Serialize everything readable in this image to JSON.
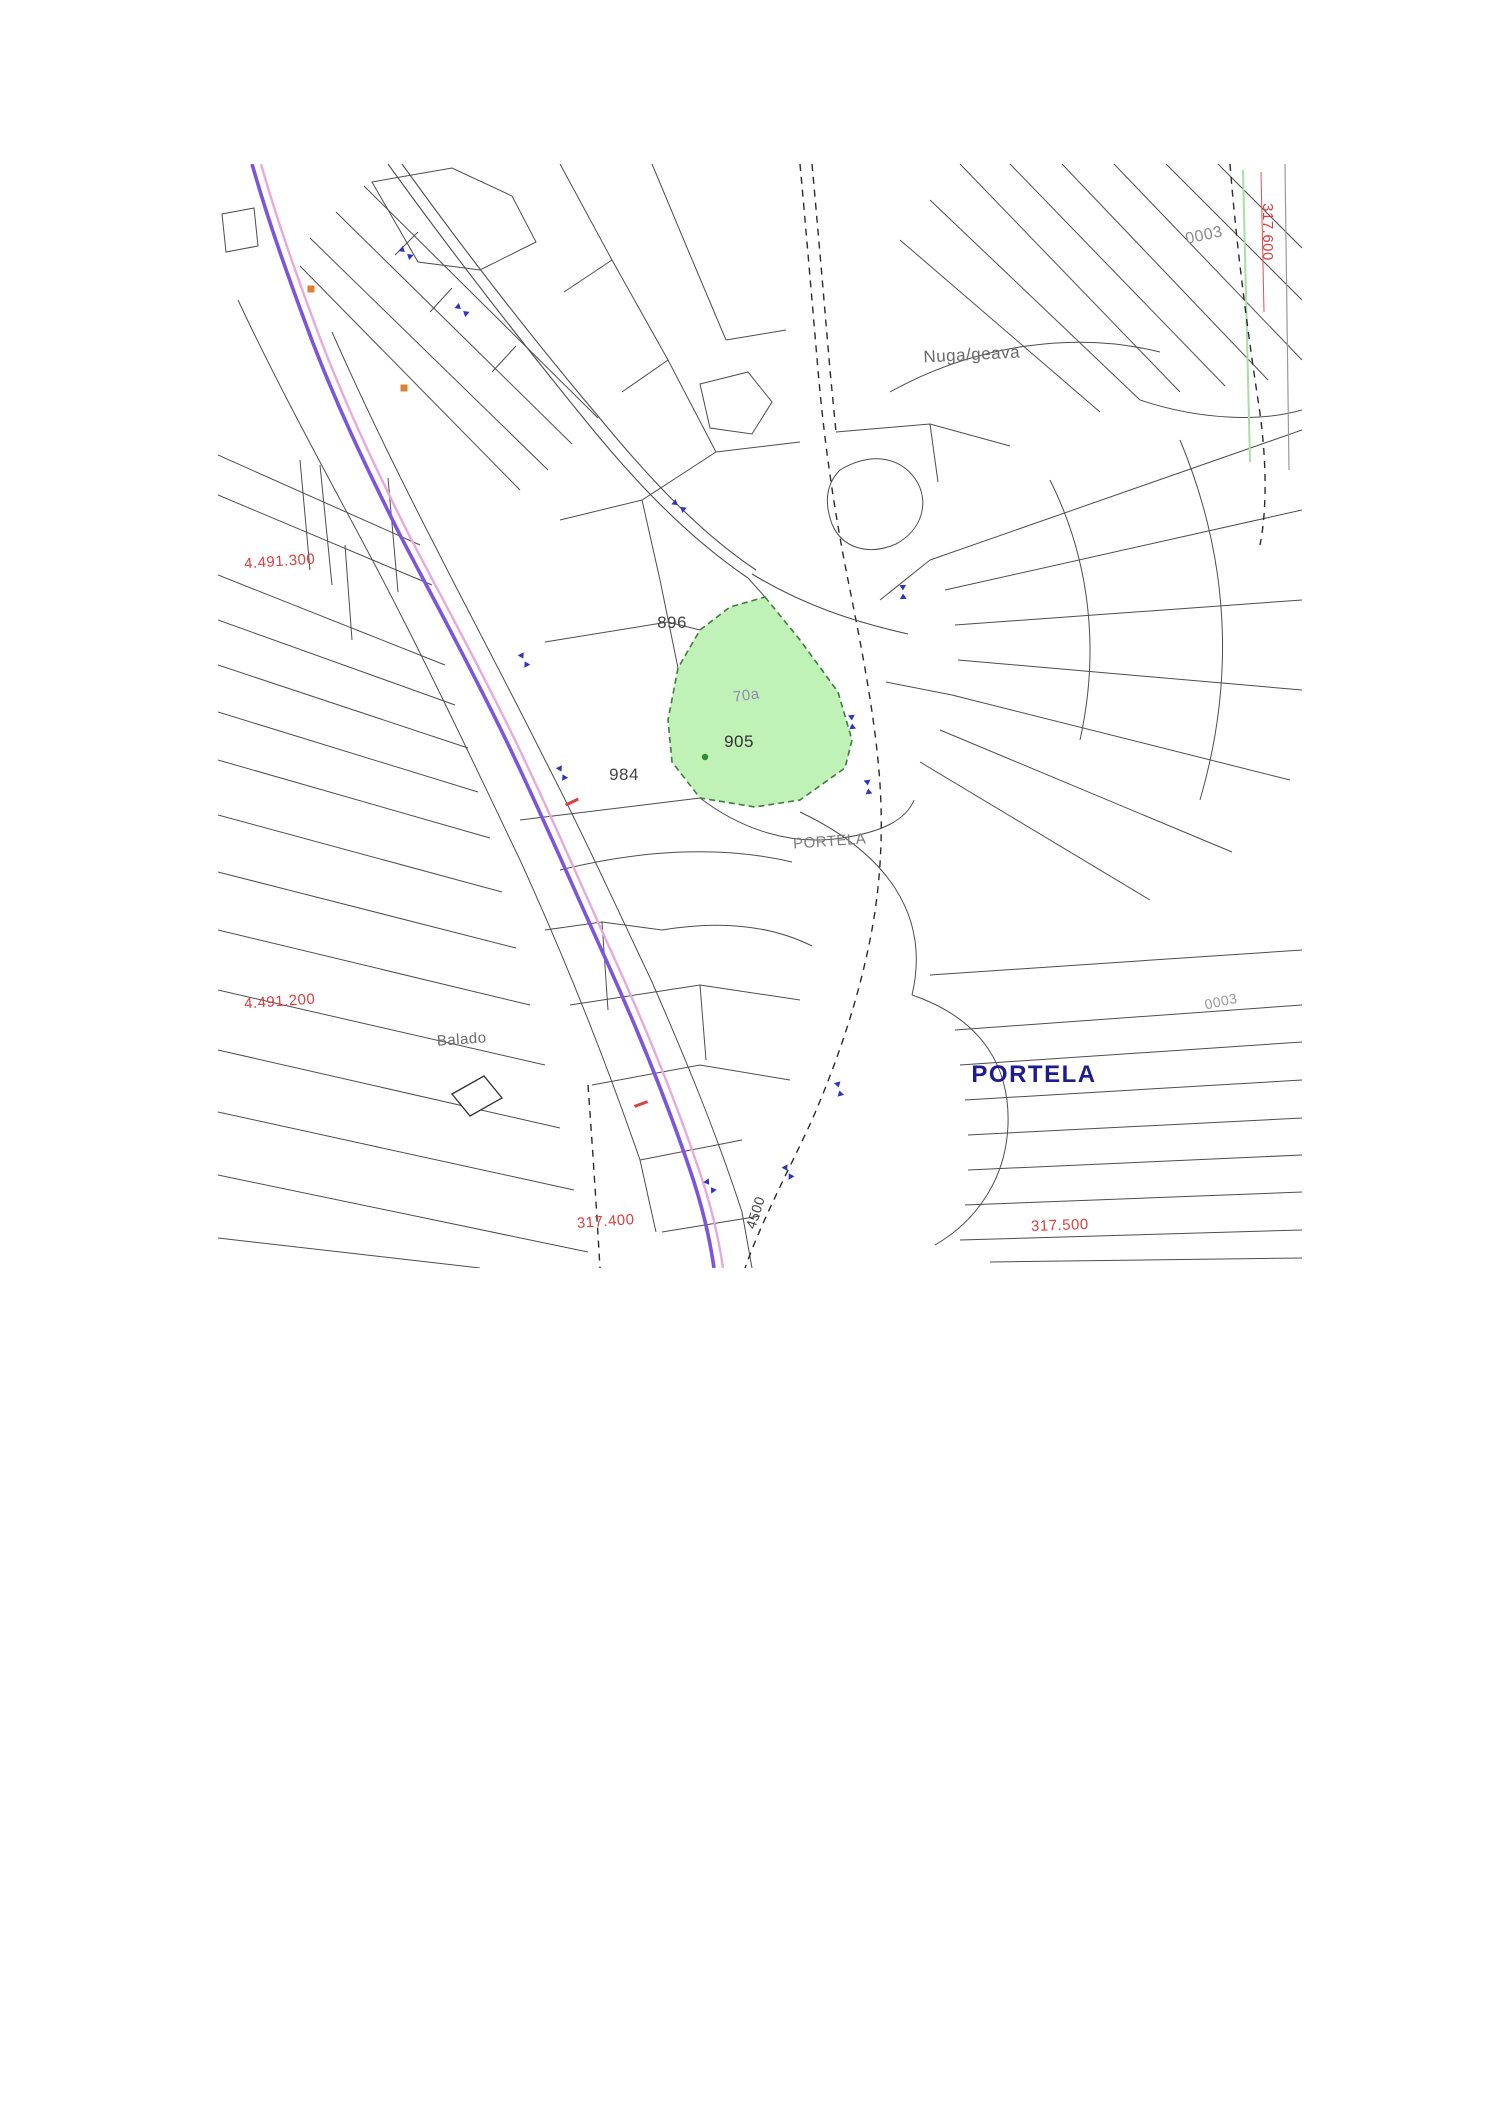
{
  "page": {
    "background": "#ffffff"
  },
  "map": {
    "name": "cadastral-parcel-map",
    "region": {
      "left": 218,
      "top": 164,
      "width": 1084,
      "height": 1104
    },
    "palette": {
      "road_main": "#7a55e0",
      "road_edge": "#e9a9d8",
      "parcel_line": "#4d4d4d",
      "dashed_path": "#2b2b2b",
      "highlight_fill": "#b9f0ae",
      "highlight_stroke": "#3f7a3f",
      "grid_label_red": "#d94040",
      "marker_blue": "#2b35c0",
      "town_label_blue": "#1c1c8f",
      "orange_tick": "#e08030"
    },
    "road": {
      "edge": "M 261,164 C 277,220 294,268 317,330 C 344,402 374,465 409,535 C 444,602 477,662 514,738 C 549,810 581,885 616,962 C 649,1035 677,1105 699,1170 C 711,1205 719,1240 723,1268",
      "main": "M 252,164 C 268,220 285,268 308,330 C 335,402 365,465 400,535 C 435,602 468,662 505,738 C 540,810 572,885 607,962 C 640,1035 668,1105 690,1170 C 702,1205 710,1240 714,1268"
    },
    "secondary_road": [
      "M 388,164 C 450,250 520,340 585,420 C 640,488 692,540 748,578",
      "M 402,164 C 464,250 532,338 598,416 C 652,482 702,534 756,570",
      "M 752,574 C 805,606 855,622 908,634"
    ],
    "dashed_paths": [
      "M 800,164 C 806,230 812,300 818,370 C 824,440 834,510 848,580 C 860,640 872,700 878,760 C 884,820 882,880 870,940 C 858,1000 838,1060 812,1120 C 788,1172 762,1220 745,1268",
      "M 812,164 C 818,230 824,300 830,370 L 836,432",
      "M 588,1085 C 592,1140 596,1200 600,1268",
      "M 1230,164 C 1236,240 1246,320 1258,400 C 1266,450 1268,505 1260,545"
    ],
    "grid_lines": [
      {
        "d": "M 1261,172 L 1264,312",
        "color": "#e05050",
        "width": 1
      },
      {
        "d": "M 1285,164 L 1289,470",
        "color": "#9a9a9a",
        "width": 1.2
      },
      {
        "d": "M 1243,170 L 1250,462",
        "color": "#a8dca8",
        "width": 2
      }
    ],
    "parcel_lines": [
      "M 218,455 L 420,545",
      "M 218,495 L 432,585",
      "M 218,575 L 445,665",
      "M 218,620 L 455,705",
      "M 218,665 L 468,748",
      "M 218,712 L 478,792",
      "M 218,760 L 490,838",
      "M 218,815 L 502,892",
      "M 218,872 L 516,948",
      "M 218,930 L 530,1005",
      "M 218,990 L 545,1065",
      "M 218,1050 L 560,1128",
      "M 218,1112 L 574,1190",
      "M 218,1175 L 588,1252",
      "M 218,1238 L 480,1268",
      "M 320,465 L 332,585",
      "M 388,478 L 398,592",
      "M 300,460 L 310,570",
      "M 345,545 L 352,640",
      "M 222,214 L 254,208 L 258,246 L 226,252 Z",
      "M 310,238 L 548,470",
      "M 336,212 L 572,444",
      "M 364,186 L 598,418",
      "M 300,266 L 520,490",
      "M 430,312 L 452,288",
      "M 492,372 L 516,346",
      "M 395,255 L 418,232",
      "M 372,182 L 452,168 L 512,196 L 536,242 L 480,270 L 418,262 Z",
      "M 560,164 L 612,260 L 668,360 L 716,452",
      "M 652,164 L 688,250 L 726,340",
      "M 726,340 L 786,330",
      "M 668,360 L 622,392",
      "M 716,452 L 800,442",
      "M 612,260 L 564,292",
      "M 700,384 L 748,372 L 772,402 L 752,434 L 710,428 Z",
      "M 238,300 C 280,390 330,480 375,565 C 420,650 470,755 520,860 C 562,952 602,1050 640,1160 L 656,1232",
      "M 332,332 C 362,400 396,470 432,540 C 470,615 506,682 546,762 C 582,832 616,906 652,982 C 686,1060 716,1132 742,1212 L 752,1268",
      "M 560,520 L 642,500 L 716,452",
      "M 545,642 L 668,622 L 700,630",
      "M 520,820 L 700,798",
      "M 642,500 L 660,580 L 678,668",
      "M 748,578 L 765,597",
      "M 700,798 C 742,830 792,846 842,838 C 882,832 906,820 914,800",
      "M 840,470 C 870,452 900,456 916,480 C 930,502 922,530 896,544 C 868,556 842,548 832,524 C 824,502 826,484 840,470",
      "M 930,560 L 1302,430",
      "M 945,590 L 1302,510",
      "M 955,625 L 1302,600",
      "M 958,660 L 1302,690",
      "M 952,695 L 1290,780",
      "M 940,730 L 1232,852",
      "M 920,762 L 1150,900",
      "M 1050,480 C 1090,560 1100,650 1080,740",
      "M 1180,440 C 1230,560 1235,680 1200,800",
      "M 880,600 L 930,560",
      "M 886,682 L 952,695",
      "M 960,164 L 1180,392",
      "M 1010,164 L 1225,386",
      "M 1062,164 L 1268,380",
      "M 1114,164 L 1302,360",
      "M 1166,164 L 1302,300",
      "M 1218,164 L 1302,248",
      "M 930,200 L 1140,400",
      "M 900,240 L 1100,412",
      "M 1140,400 C 1200,420 1260,422 1302,410",
      "M 890,392 C 980,342 1080,332 1160,352",
      "M 836,432 L 930,424 L 1010,446",
      "M 930,424 L 938,482",
      "M 955,1030 L 1302,1005",
      "M 960,1065 L 1302,1042",
      "M 965,1100 L 1302,1080",
      "M 968,1135 L 1302,1118",
      "M 968,1170 L 1302,1155",
      "M 965,1205 L 1302,1192",
      "M 960,1240 L 1302,1230",
      "M 990,1262 L 1302,1258",
      "M 912,995 C 985,1020 1010,1070 1008,1125 C 1006,1180 975,1222 935,1245",
      "M 930,975 L 1302,950",
      "M 800,812 C 880,850 932,910 912,995",
      "M 560,870 C 640,850 720,845 792,862",
      "M 545,930 L 602,922 L 662,930",
      "M 602,922 L 608,1010",
      "M 662,930 C 722,920 772,926 812,946",
      "M 570,1005 L 700,985 L 800,1000",
      "M 700,985 L 706,1060",
      "M 592,1085 L 700,1065 L 790,1080",
      "M 640,1160 L 742,1140",
      "M 662,1232 L 760,1216"
    ],
    "buildings": [
      {
        "d": "M 452,1094 L 484,1076 L 502,1098 L 470,1116 Z"
      }
    ],
    "highlight_parcel": {
      "path": "M 765,597 L 800,640 L 838,692 L 852,740 L 845,768 L 800,800 L 755,807 L 700,798 L 672,762 L 668,720 L 678,668 L 700,630 L 730,607 Z",
      "dot": {
        "x": 705,
        "y": 757
      }
    },
    "blue_markers": [
      {
        "x": 406,
        "y": 253,
        "rot": 40
      },
      {
        "x": 462,
        "y": 310,
        "rot": 40
      },
      {
        "x": 679,
        "y": 506,
        "rot": 38
      },
      {
        "x": 524,
        "y": 660,
        "rot": 62
      },
      {
        "x": 562,
        "y": 773,
        "rot": 64
      },
      {
        "x": 903,
        "y": 592,
        "rot": 88
      },
      {
        "x": 852,
        "y": 722,
        "rot": 85
      },
      {
        "x": 868,
        "y": 787,
        "rot": 82
      },
      {
        "x": 839,
        "y": 1089,
        "rot": 75
      },
      {
        "x": 788,
        "y": 1172,
        "rot": 60
      },
      {
        "x": 710,
        "y": 1186,
        "rot": 55
      }
    ],
    "orange_ticks": [
      {
        "x": 311,
        "y": 289
      },
      {
        "x": 404,
        "y": 388
      }
    ],
    "red_ticks": [
      {
        "x": 572,
        "y": 802,
        "rot": -25
      },
      {
        "x": 641,
        "y": 1104,
        "rot": -20
      }
    ],
    "labels": [
      {
        "id": "parcel-0003-top",
        "text": "0003",
        "x": 1205,
        "y": 240,
        "size": 16,
        "color": "#8a8a8a",
        "rot": -12,
        "bold": false
      },
      {
        "id": "grid-317600",
        "text": "317.600",
        "x": 1263,
        "y": 232,
        "size": 15,
        "color": "#d94040",
        "rot": 90,
        "bold": false
      },
      {
        "id": "place-nuga-geava",
        "text": "Nuga/geava",
        "x": 972,
        "y": 360,
        "size": 17,
        "color": "#6a6a6a",
        "rot": -3,
        "bold": false
      },
      {
        "id": "grid-4491300",
        "text": "4.491.300",
        "x": 280,
        "y": 566,
        "size": 15,
        "color": "#d94040",
        "rot": -4,
        "bold": false
      },
      {
        "id": "parcel-896",
        "text": "896",
        "x": 672,
        "y": 628,
        "size": 17,
        "color": "#444444",
        "rot": 0,
        "bold": false
      },
      {
        "id": "parcel-70a",
        "text": "70a",
        "x": 747,
        "y": 700,
        "size": 15,
        "color": "#9087b0",
        "rot": -8,
        "bold": false
      },
      {
        "id": "parcel-905",
        "text": "905",
        "x": 739,
        "y": 747,
        "size": 17,
        "color": "#333333",
        "rot": 0,
        "bold": false
      },
      {
        "id": "parcel-984",
        "text": "984",
        "x": 624,
        "y": 780,
        "size": 17,
        "color": "#444444",
        "rot": 0,
        "bold": false
      },
      {
        "id": "place-portela-small",
        "text": "PORTELA",
        "x": 830,
        "y": 846,
        "size": 15,
        "color": "#7a7a7a",
        "rot": -4,
        "bold": false
      },
      {
        "id": "grid-4491200",
        "text": "4.491.200",
        "x": 280,
        "y": 1006,
        "size": 15,
        "color": "#d94040",
        "rot": -4,
        "bold": false
      },
      {
        "id": "place-balado",
        "text": "Balado",
        "x": 462,
        "y": 1044,
        "size": 15,
        "color": "#6a6a6a",
        "rot": -4,
        "bold": false
      },
      {
        "id": "place-portela",
        "text": "PORTELA",
        "x": 1034,
        "y": 1082,
        "size": 24,
        "color": "#1c1c8f",
        "rot": 0,
        "bold": true
      },
      {
        "id": "parcel-0003-bottom",
        "text": "0003",
        "x": 1222,
        "y": 1006,
        "size": 14,
        "color": "#999999",
        "rot": -12,
        "bold": false
      },
      {
        "id": "road-4500",
        "text": "4500",
        "x": 760,
        "y": 1214,
        "size": 14,
        "color": "#444444",
        "rot": -72,
        "bold": false
      },
      {
        "id": "grid-317400",
        "text": "317.400",
        "x": 606,
        "y": 1226,
        "size": 15,
        "color": "#d94040",
        "rot": -4,
        "bold": false
      },
      {
        "id": "grid-317500",
        "text": "317.500",
        "x": 1060,
        "y": 1230,
        "size": 15,
        "color": "#d94040",
        "rot": -2,
        "bold": false
      }
    ]
  }
}
